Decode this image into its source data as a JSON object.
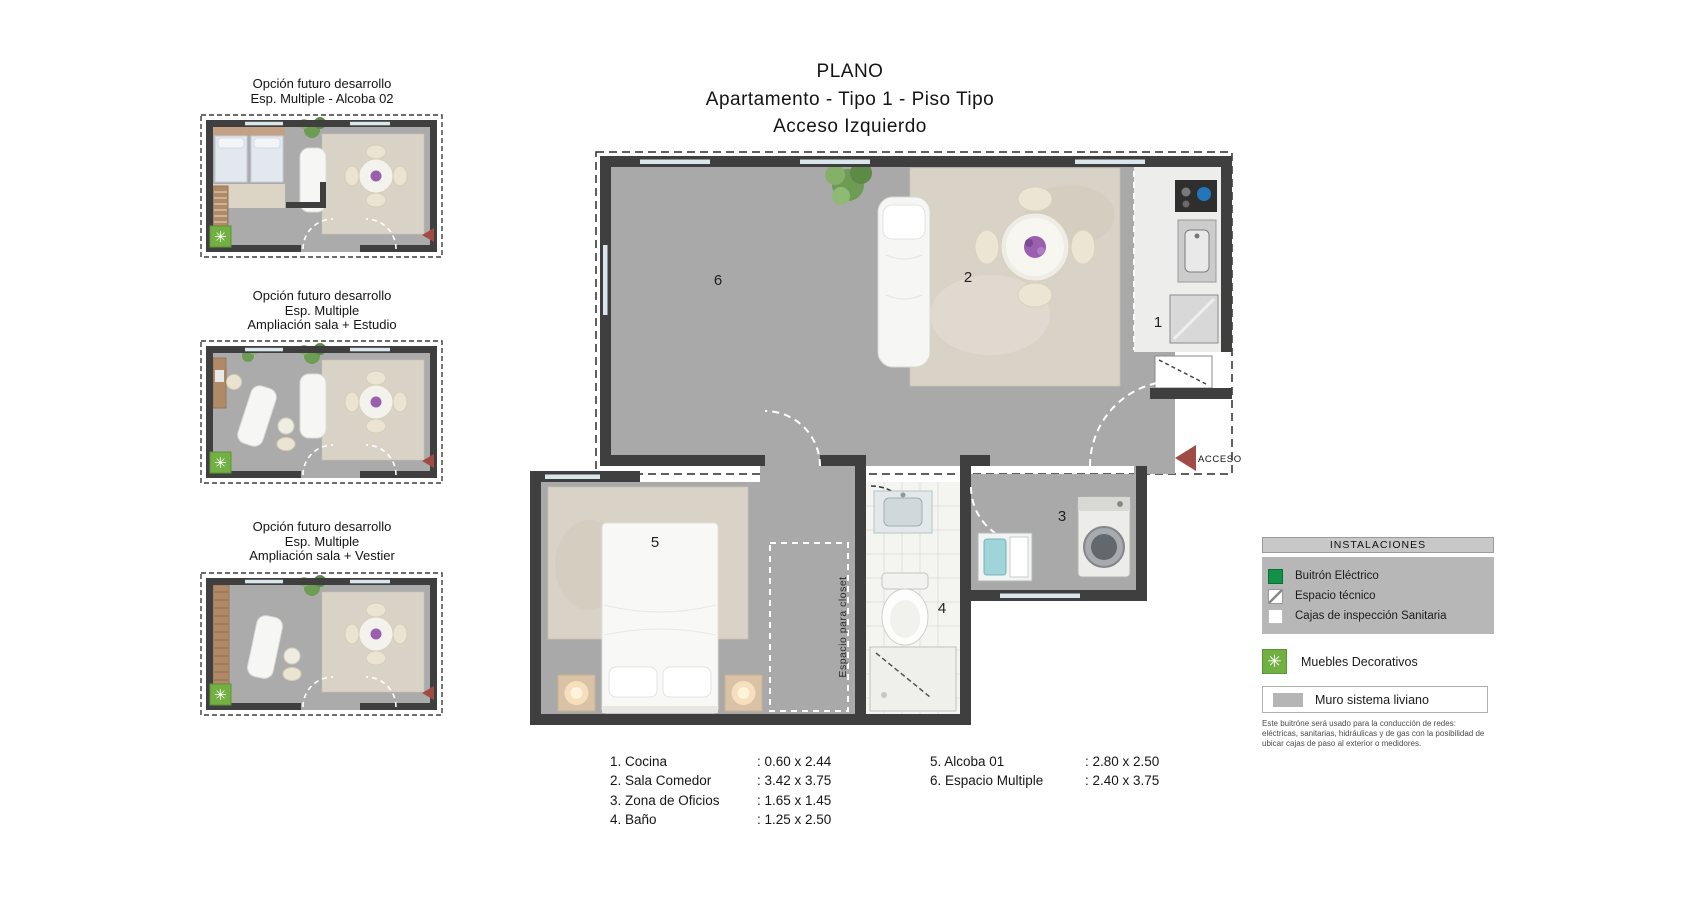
{
  "title": {
    "line1": "PLANO",
    "line2": "Apartamento - Tipo 1 - Piso Tipo",
    "line3": "Acceso Izquierdo"
  },
  "options": [
    {
      "caption": [
        "Opción futuro desarrollo",
        "Esp. Multiple - Alcoba 02"
      ]
    },
    {
      "caption": [
        "Opción futuro desarrollo",
        "Esp. Multiple",
        "Ampliación sala + Estudio"
      ]
    },
    {
      "caption": [
        "Opción futuro desarrollo",
        "Esp. Multiple",
        "Ampliación sala + Vestier"
      ]
    }
  ],
  "main_plan": {
    "access_label": "ACCESO",
    "closet_label": "Espacio para closet",
    "rooms": {
      "kitchen": "1",
      "living": "2",
      "oficios": "3",
      "bath": "4",
      "bedroom": "5",
      "multiple": "6"
    }
  },
  "legend": {
    "header": "INSTALACIONES",
    "items": [
      {
        "label": "Buitrón Eléctrico",
        "swatch": "green"
      },
      {
        "label": "Espacio técnico",
        "swatch": "diagonal"
      },
      {
        "label": "Cajas de inspección Sanitaria",
        "swatch": "white"
      }
    ],
    "decorative_label": "Muebles Decorativos",
    "muro_label": "Muro sistema liviano",
    "footnote": "Este buitróne será usado para la conducción de redes: eléctricas, sanitarias, hidráulicas y de gas con la posibilidad de ubicar cajas de paso al exterior o medidores."
  },
  "room_list": {
    "col1": [
      {
        "label": "1. Cocina",
        "dim": ": 0.60 x 2.44"
      },
      {
        "label": "2. Sala Comedor",
        "dim": ": 3.42 x 3.75"
      },
      {
        "label": "3. Zona de Oficios",
        "dim": ": 1.65 x 1.45"
      },
      {
        "label": "4. Baño",
        "dim": ": 1.25 x 2.50"
      }
    ],
    "col2": [
      {
        "label": "5. Alcoba 01",
        "dim": ": 2.80 x 2.50"
      },
      {
        "label": "6. Espacio Multiple",
        "dim": ": 2.40 x 3.75"
      }
    ]
  },
  "icons": {
    "decorative_asterisk": "✳"
  },
  "colors": {
    "accent_red": "#a04b46",
    "legend_green": "#149149",
    "asterisk_green": "#72b043",
    "wall": "#3f3f3f",
    "floor": "#a9a9a9",
    "rug": "#d9d3c7"
  }
}
